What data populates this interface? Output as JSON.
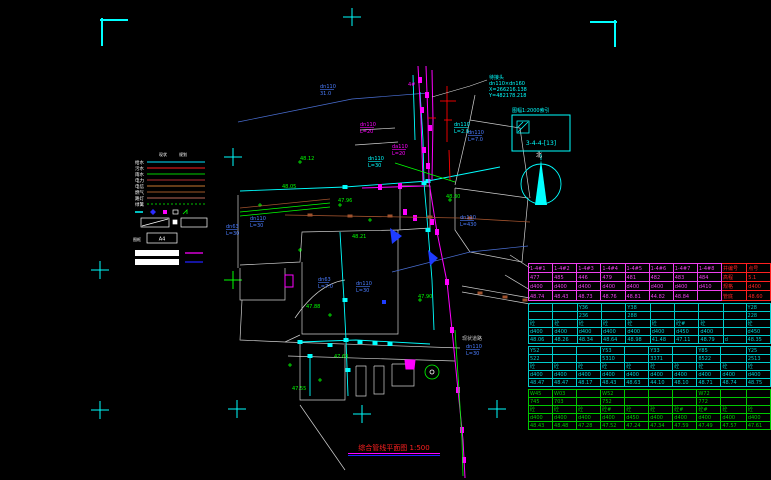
{
  "footer": {
    "title": "综合管线平面图 1:500"
  },
  "annotations": {
    "junction": [
      "待接头",
      "dn110×dn160",
      "X=266216.138",
      "Y=482178.218"
    ]
  },
  "index_box": {
    "label": "图幅1:2000索引",
    "code": "3-4-4-[13]"
  },
  "north": {
    "label": "北"
  },
  "legend": {
    "headers": [
      "现状",
      "规划"
    ],
    "rows": [
      {
        "label": "给水",
        "color": "#00e5ff",
        "style": "solid"
      },
      {
        "label": "污水",
        "color": "#ff2020",
        "style": "solid"
      },
      {
        "label": "雨水",
        "color": "#00d000",
        "style": "solid"
      },
      {
        "label": "电力",
        "color": "#b03030",
        "style": "solid"
      },
      {
        "label": "电信",
        "color": "#c87830",
        "style": "solid"
      },
      {
        "label": "燃气",
        "color": "#a05828",
        "style": "solid"
      },
      {
        "label": "路灯",
        "color": "#b86858",
        "style": "solid"
      },
      {
        "label": "绿篱",
        "color": "#00c000",
        "style": "dotted"
      }
    ],
    "frame_label": "A4",
    "box_label": "图框"
  },
  "map": {
    "labels": [
      {
        "a": "dn110",
        "b": "31.0",
        "x": 320,
        "y": 88,
        "c": "#4a7cff"
      },
      {
        "a": "dn110",
        "b": "L=7.0",
        "x": 468,
        "y": 134,
        "c": "#4a7cff"
      },
      {
        "a": "dn110",
        "b": "L=430",
        "x": 460,
        "y": 219,
        "c": "#4a7cff"
      },
      {
        "a": "dn63",
        "b": "L=30",
        "x": 226,
        "y": 228,
        "c": "#4a7cff"
      },
      {
        "a": "dn110",
        "b": "L=30",
        "x": 250,
        "y": 220,
        "c": "#4a7cff"
      },
      {
        "a": "dn63",
        "b": "L=7.0",
        "x": 318,
        "y": 281,
        "c": "#4a7cff"
      },
      {
        "a": "dn110",
        "b": "L=30",
        "x": 356,
        "y": 285,
        "c": "#4a7cff"
      },
      {
        "a": "dn110",
        "b": "L=30",
        "x": 466,
        "y": 348,
        "c": "#4a7cff"
      },
      {
        "a": "dn110",
        "b": "L=20",
        "x": 360,
        "y": 126,
        "c": "#f0f"
      },
      {
        "a": "da110",
        "b": "L=20",
        "x": 392,
        "y": 148,
        "c": "#f0f"
      },
      {
        "a": "4#",
        "b": "",
        "x": 408,
        "y": 86,
        "c": "#f0f"
      },
      {
        "a": "dn110",
        "b": "L=2.0",
        "x": 454,
        "y": 126,
        "c": "#0ff"
      },
      {
        "a": "dn110",
        "b": "L=30",
        "x": 368,
        "y": 160,
        "c": "#0ff"
      },
      {
        "a": "48.12",
        "b": "",
        "x": 300,
        "y": 160,
        "c": "#0f0"
      },
      {
        "a": "47.96",
        "b": "",
        "x": 338,
        "y": 202,
        "c": "#0f0"
      },
      {
        "a": "48.05",
        "b": "",
        "x": 282,
        "y": 188,
        "c": "#0f0"
      },
      {
        "a": "48.21",
        "b": "",
        "x": 352,
        "y": 238,
        "c": "#0f0"
      },
      {
        "a": "47.88",
        "b": "",
        "x": 306,
        "y": 308,
        "c": "#0f0"
      },
      {
        "a": "47.63",
        "b": "",
        "x": 334,
        "y": 358,
        "c": "#0f0"
      },
      {
        "a": "47.90",
        "b": "",
        "x": 418,
        "y": 298,
        "c": "#0f0"
      },
      {
        "a": "48.30",
        "b": "",
        "x": 446,
        "y": 198,
        "c": "#0f0"
      },
      {
        "a": "47.55",
        "b": "",
        "x": 292,
        "y": 390,
        "c": "#0f0"
      },
      {
        "a": "现状道路",
        "b": "",
        "x": 462,
        "y": 340,
        "c": "#cccccc"
      }
    ]
  },
  "table": {
    "blocks": [
      {
        "color": "#f040f0",
        "red_last_cols": 2,
        "rows": [
          [
            "1-4#1",
            "1-4#2",
            "1-4#3",
            "1-4#4",
            "1-4#5",
            "1-4#6",
            "1-4#7",
            "1-4#8",
            "井编号",
            "点号"
          ],
          [
            "477",
            "485",
            "446",
            "479",
            "481",
            "482",
            "483",
            "484",
            "高程",
            "5.1"
          ],
          [
            "d400",
            "d400",
            "d400",
            "d400",
            "d400",
            "d400",
            "d400",
            "d410",
            "规格",
            "d400"
          ],
          [
            "48.74",
            "48.43",
            "48.73",
            "48.76",
            "48.81",
            "44.82",
            "48.84",
            "",
            "管底",
            "48.60"
          ]
        ]
      },
      {
        "color": "#00cccc",
        "red_last_cols": 0,
        "rows": [
          [
            "",
            "",
            "Y36",
            "",
            "Y38",
            "",
            "",
            "",
            "",
            "Y28"
          ],
          [
            "",
            "",
            "236",
            "",
            "288",
            "",
            "",
            "",
            "",
            "228"
          ],
          [
            "砼",
            "砼",
            "砼",
            "砼",
            "砼",
            "砼",
            "砼#",
            "砼",
            "",
            "砼"
          ],
          [
            "d400",
            "d400",
            "d400",
            "d400",
            "d400",
            "d400",
            "d450",
            "d400",
            "",
            "d450"
          ],
          [
            "48.06",
            "48.26",
            "48.34",
            "48.64",
            "48.98",
            "41.48",
            "47.11",
            "48.79",
            "d",
            "48.35"
          ]
        ]
      },
      {
        "color": "#00cccc",
        "red_last_cols": 0,
        "rows": [
          [
            "Y52",
            "",
            "",
            "Y53",
            "",
            "Y33",
            "",
            "Y85",
            "",
            "Y25"
          ],
          [
            "522",
            "",
            "",
            "5310",
            "",
            "3371",
            "",
            "8522",
            "",
            "2513"
          ],
          [
            "砼",
            "砼",
            "砼",
            "砼",
            "砼",
            "砼",
            "砼",
            "砼",
            "砼",
            "砼"
          ],
          [
            "d400",
            "d400",
            "d400",
            "d400",
            "d400",
            "d400",
            "d400",
            "d400",
            "d400",
            "d400"
          ],
          [
            "48.47",
            "48.47",
            "48.17",
            "48.43",
            "48.63",
            "44.10",
            "48.10",
            "48.71",
            "48.74",
            "48.75"
          ]
        ]
      },
      {
        "color": "#00c800",
        "red_last_cols": 0,
        "rows": [
          [
            "W45",
            "W03",
            "",
            "W52",
            "",
            "",
            "",
            "W72",
            "",
            ""
          ],
          [
            "745",
            "703",
            "",
            "752",
            "",
            "",
            "",
            "772",
            "",
            ""
          ],
          [
            "砼",
            "砼",
            "砼",
            "砼#",
            "砼",
            "砼",
            "砼#",
            "砼#",
            "砼",
            "砼"
          ],
          [
            "d400",
            "d400",
            "d400",
            "d400",
            "d450",
            "d400",
            "d400",
            "d400",
            "d400",
            "d400"
          ],
          [
            "48.43",
            "48.48",
            "47.28",
            "47.52",
            "47.24",
            "47.34",
            "47.59",
            "47.49",
            "47.57",
            "47.61"
          ]
        ]
      }
    ]
  }
}
